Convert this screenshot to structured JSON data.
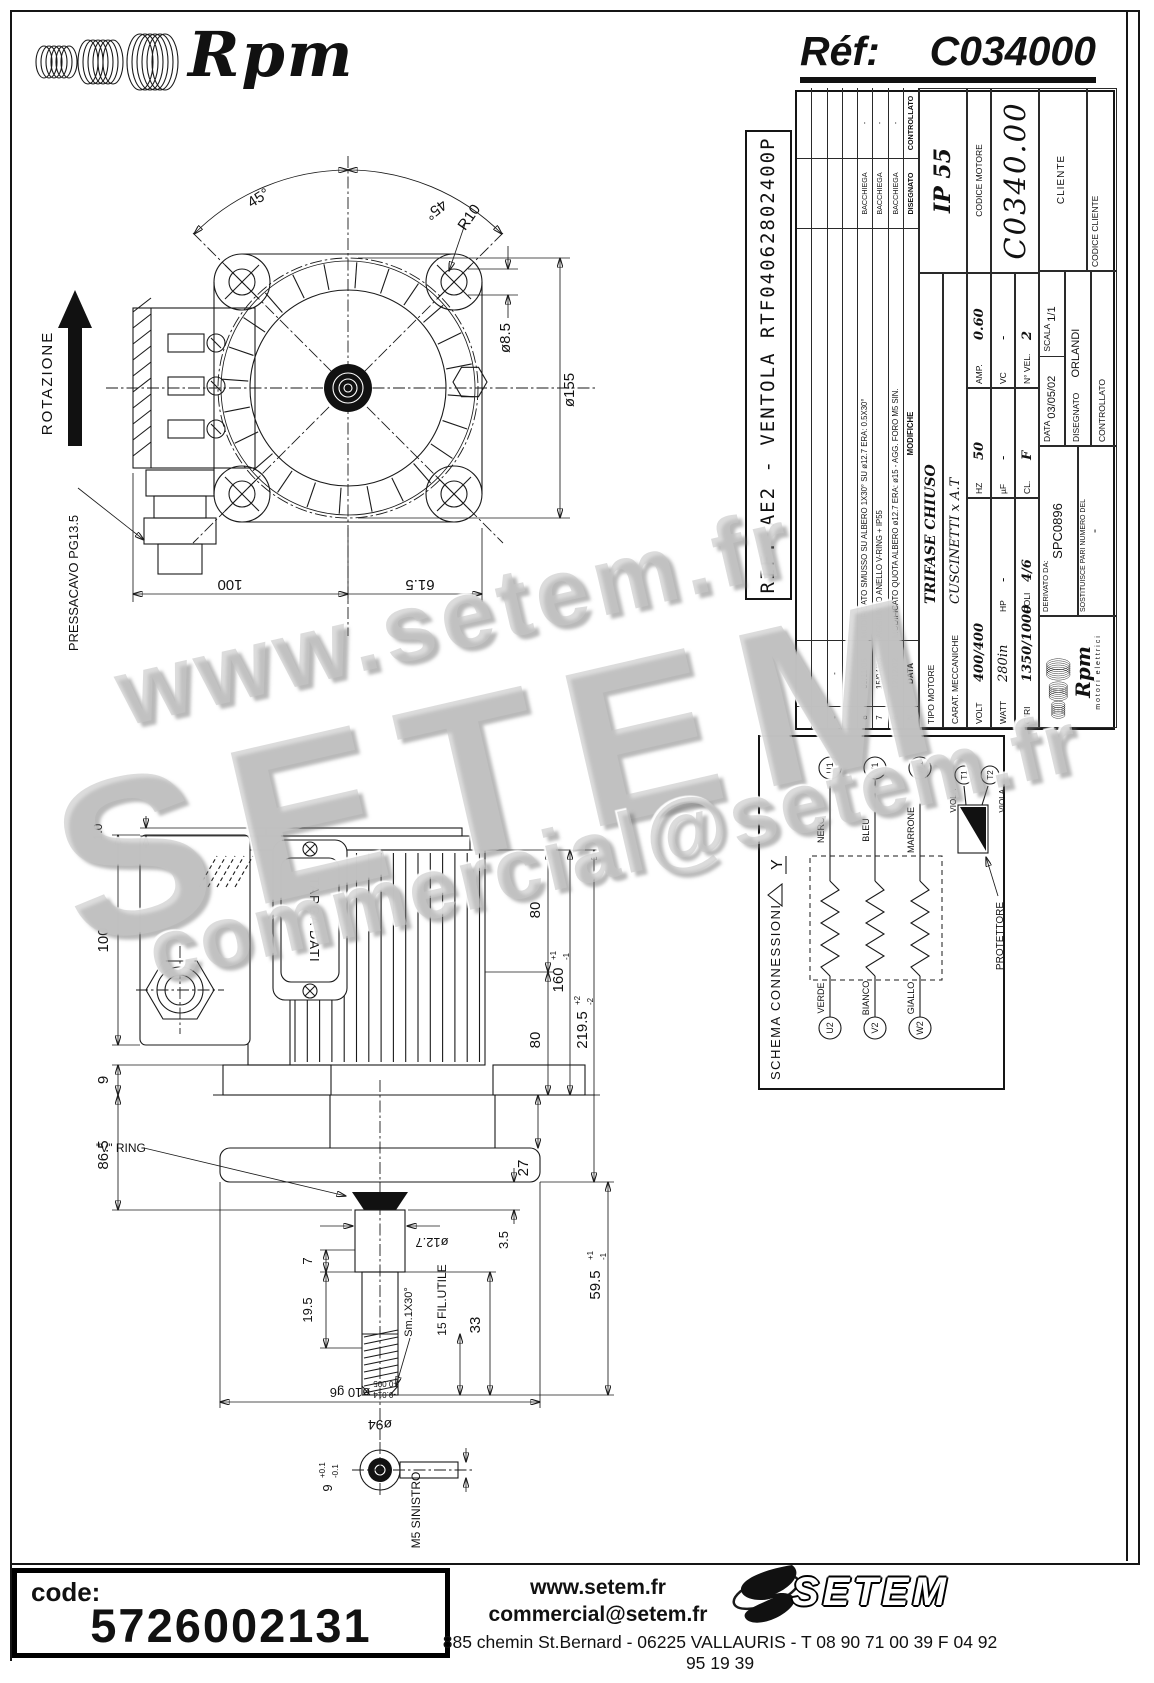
{
  "header": {
    "brand": "Rpm",
    "ref_label": "Réf:",
    "ref_value": "C034000"
  },
  "rif_box": {
    "text": "RIF. AE2 - VENTOLA RTF04062802400P"
  },
  "title_block": {
    "mod_table": {
      "headers": {
        "n": "N",
        "data": "DATA",
        "modifiche": "MODIFICHE",
        "disegnato": "DISEGNATO",
        "controllato": "CONTROLLATO"
      },
      "rows": [
        {
          "n": "",
          "date": "",
          "desc": "",
          "by": "",
          "ctrl": ""
        },
        {
          "n": "",
          "date": "",
          "desc": "",
          "by": "",
          "ctrl": ""
        },
        {
          "n": "-",
          "date": "-",
          "desc": "",
          "by": "",
          "ctrl": ""
        },
        {
          "n": "-",
          "date": "-",
          "desc": "",
          "by": "",
          "ctrl": ""
        },
        {
          "n": "8",
          "date": "09/11/05",
          "desc": "MODIFICATO SMUSSO SU ALBERO 1X30° SU ø12.7 ERA: 0.5X30°",
          "by": "BACCHIEGA",
          "ctrl": "-"
        },
        {
          "n": "7",
          "date": "15/04/03",
          "desc": "AGGIUNTO ANELLO V-RING + IP55",
          "by": "BACCHIEGA",
          "ctrl": "-"
        },
        {
          "n": "6",
          "date": "12/12/02",
          "desc": "MODIFICATO QUOTA ALBERO ø12.7 ERA: ø15 - AGG. FORO M5 SIN.",
          "by": "BACCHIEGA",
          "ctrl": "-"
        }
      ]
    },
    "tipo_motore_label": "TIPO MOTORE",
    "tipo_motore": "TRIFASE CHIUSO",
    "carat_label": "CARAT. MECCANICHE",
    "carat": "CUSCINETTI x A.T",
    "ip": "IP 55",
    "electrical": {
      "volt_label": "VOLT",
      "volt": "400/400",
      "hz_label": "HZ",
      "hz": "50",
      "amp_label": "AMP.",
      "amp": "0.60",
      "watt_label": "WATT",
      "watt": "280in",
      "hp_label": "HP",
      "hp": "-",
      "uf_label": "µF",
      "uf": "-",
      "vc_label": "VC",
      "vc": "-",
      "giri_label": "GIRI",
      "giri": "1350/1000",
      "poli_label": "POLI",
      "poli": "4/6",
      "cl_label": "CL.",
      "cl": "F",
      "nvel_label": "N° VEL.",
      "nvel": "2"
    },
    "codice_motore_label": "CODICE MOTORE",
    "codice_motore": "C0340.00",
    "logo_brand": "Rpm",
    "logo_sub": "motori elettrici",
    "derivato_label": "DERIVATO DA:",
    "derivato": "SPC0896",
    "sostituisce_label": "SOSTITUISCE PARI NUMERO DEL",
    "sostituisce": "-",
    "data_label": "DATA",
    "data": "03/05/02",
    "scala_label": "SCALA",
    "scala": "1/1",
    "disegnato_label": "DISEGNATO",
    "disegnato": "ORLANDI",
    "controllato_label": "CONTROLLATO",
    "cliente_label": "CLIENTE",
    "codice_cliente_label": "CODICE CLIENTE"
  },
  "schema": {
    "title": "SCHEMA CONNESSIONI",
    "wye": "Y",
    "phases": [
      {
        "t_in": "U2",
        "t_out": "U1",
        "color_in": "VERDE",
        "color_out": "NERO"
      },
      {
        "t_in": "V2",
        "t_out": "V1",
        "color_in": "BIANCO",
        "color_out": "BLEU"
      },
      {
        "t_in": "W2",
        "t_out": "W1",
        "color_in": "GIALLO",
        "color_out": "MARRONE"
      }
    ],
    "viola": "VIOLA",
    "t1": "T1",
    "t2": "T2",
    "protettore": "PROTETTORE"
  },
  "front_view": {
    "rotazione": "ROTAZIONE",
    "pressacavo": "PRESSACAVO PG13.5",
    "dims": {
      "angle_left": "45°",
      "angle_right": "45°",
      "r10": "R10",
      "d85": "ø8.5",
      "d155": "ø155",
      "d615": "61.5",
      "d100": "100"
    }
  },
  "side_view": {
    "targa": "TARGA DATI",
    "vring": "\"V\" RING",
    "dims": {
      "d10": "1.0",
      "d100": "100",
      "d9": "9",
      "d865": "86.5",
      "d80t": "80",
      "d160": "160",
      "tol1p": "+1",
      "tol1m": "-1",
      "d80b": "80",
      "d27": "27",
      "d2195": "219.5",
      "tol2p": "+2",
      "tol2m": "-2",
      "d35": "3.5",
      "d595": "59.5",
      "d33": "33",
      "fil": "15 FIL.UTILE",
      "d127": "ø12.7",
      "d7": "7",
      "d195": "19.5",
      "sm": "Sm.1X30°",
      "d10g6": "ø10 g6",
      "g6a": "-0.005",
      "g6b": "-0.014",
      "d94": "ø94",
      "m5": "M5 SINISTRO",
      "d9b": "9",
      "d9bp": "+0.1",
      "d9bm": "-0.1"
    }
  },
  "watermarks": {
    "w1": "www.setem.fr",
    "w2": "SETEM",
    "w3": "commercial@setem.fr"
  },
  "footer": {
    "code_label": "code:",
    "code": "5726002131",
    "site": "www.setem.fr",
    "email": "commercial@setem.fr",
    "brand": "SETEM",
    "address": "885 chemin St.Bernard  -  06225 VALLAURIS  -  T 08 90 71 00 39   F 04 92 95 19 39"
  }
}
